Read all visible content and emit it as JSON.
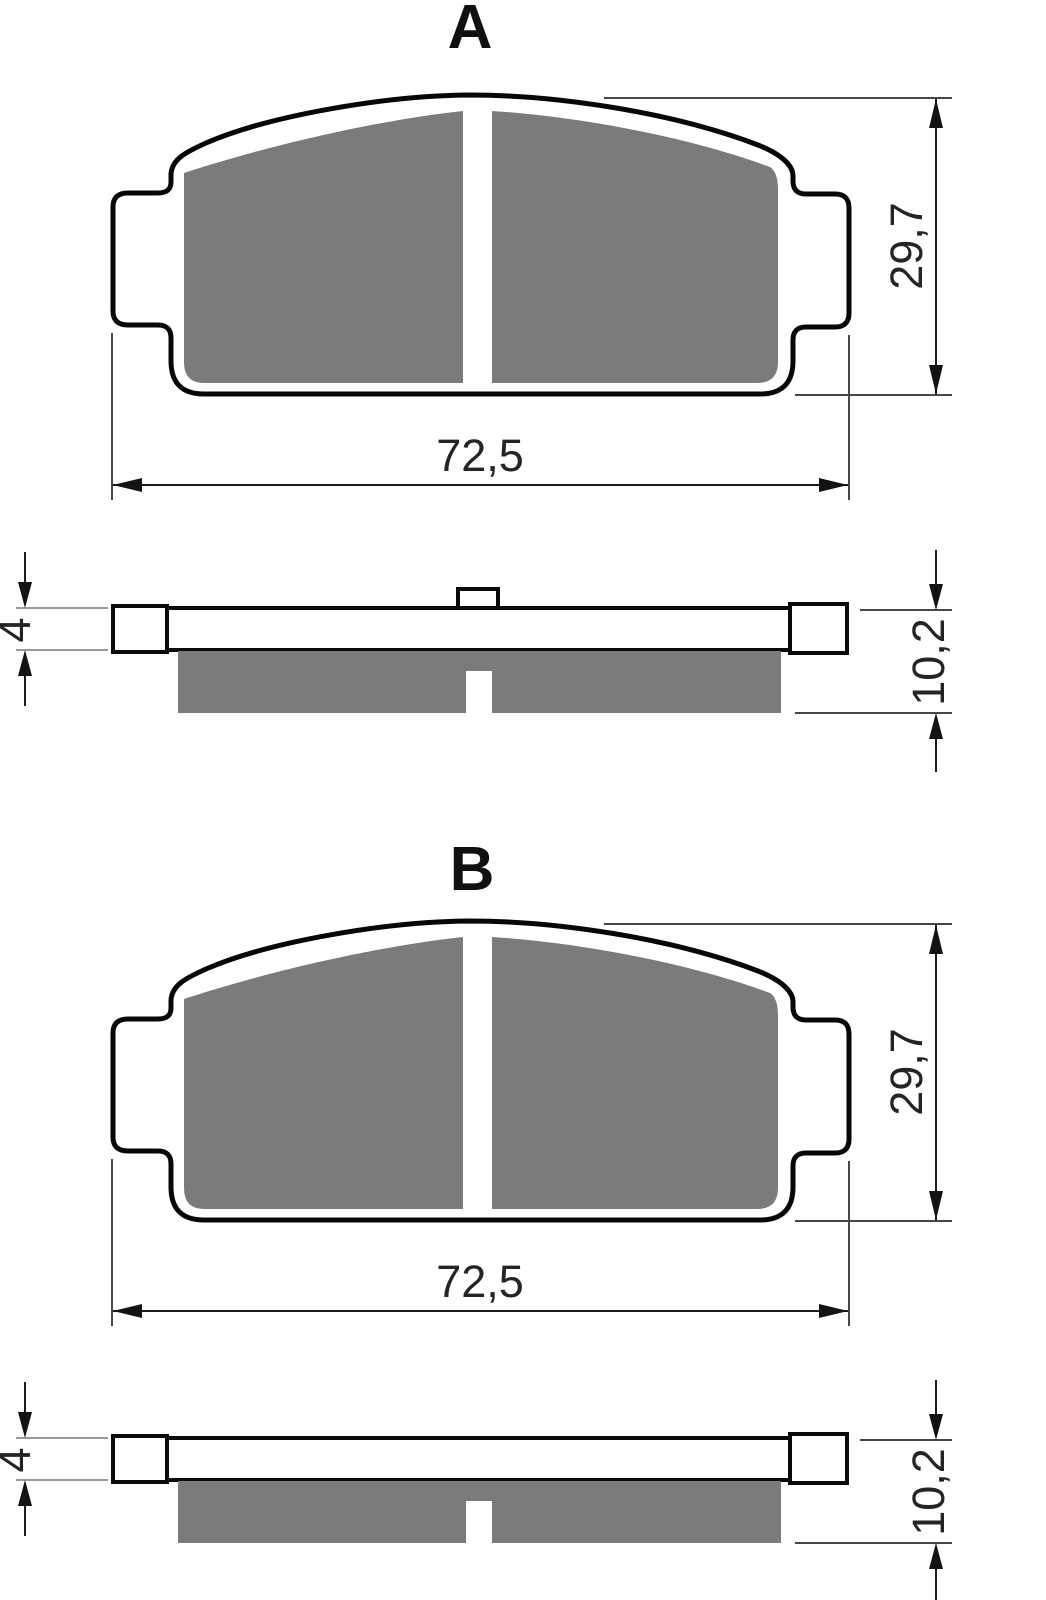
{
  "drawing": {
    "type": "brake-pad-technical-drawing",
    "views_per_section": [
      "front-view",
      "side-section-view"
    ]
  },
  "sections": [
    {
      "label": "A",
      "dimensions": {
        "width": "72,5",
        "height": "29,7",
        "backing_thickness": "4",
        "total_thickness": "10,2"
      }
    },
    {
      "label": "B",
      "dimensions": {
        "width": "72,5",
        "height": "29,7",
        "backing_thickness": "4",
        "total_thickness": "10,2"
      }
    }
  ],
  "colors": {
    "friction_material": "#7b7b7b",
    "outline": "#070707",
    "dimension_lines": "#1c1c1c",
    "light_extension_lines": "#9a9a9a",
    "background": "#ffffff"
  }
}
